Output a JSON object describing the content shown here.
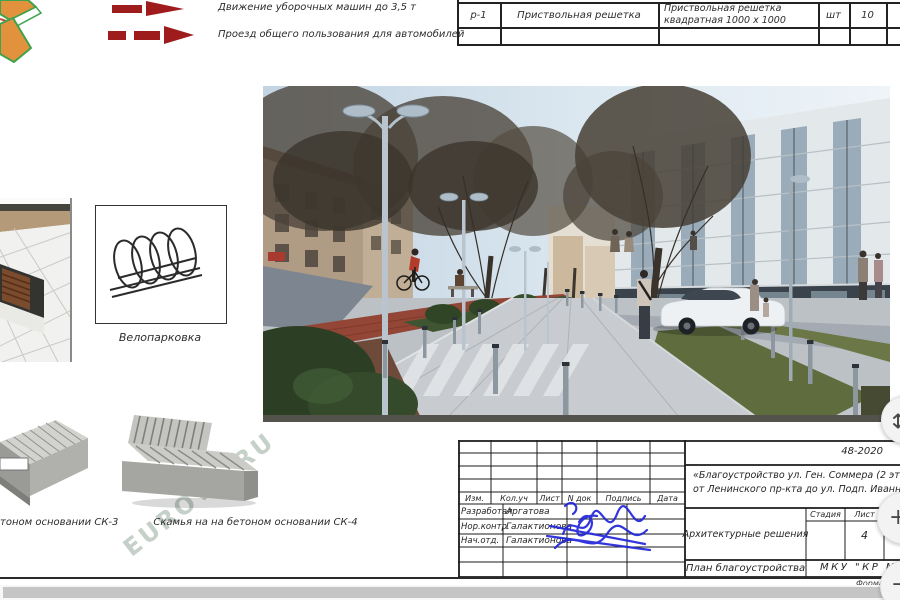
{
  "colors": {
    "legend_arrow_red": "#9e1c1c",
    "signature_blue": "#2126d8",
    "drawing_line": "#1f1f1f",
    "scrollbar_thumb": "#c5c5c5"
  },
  "legend": {
    "items": [
      {
        "label": "Движение уборочных машин до 3,5 т"
      },
      {
        "label": "Проезд общего пользования для автомобилей"
      }
    ]
  },
  "spec_table": {
    "rows": [
      {
        "mark": "р-1",
        "name": "Приствольная решетка",
        "desc_line1": "Приствольная решетка",
        "desc_line2": "квадратная 1000 х 1000",
        "unit": "шт",
        "qty": "10"
      }
    ]
  },
  "details": {
    "bike_parking_label": "Велопарковка",
    "bench_sk3_label": "тоном основании СК-3",
    "bench_sk4_label": "Скамья на на бетоном основании СК-4"
  },
  "watermark": {
    "text": "EUROVA.RU"
  },
  "title_block": {
    "doc_number": "48-2020",
    "project_line1": "«Благоустройство  ул. Ген. Соммера (2 этап",
    "project_line2": "от Ленинского пр-кта до ул. Подп. Иванникова)",
    "section_title": "Архитектурные решения",
    "sheet_title": "План благоустройства",
    "organization": "МКУ  \"КР М",
    "stage_header": "Стадия",
    "sheet_header": "Лист",
    "sheet_number": "4",
    "columns": [
      "Изм.",
      "Кол.уч",
      "Лист",
      "N док",
      "Подпись",
      "Дата"
    ],
    "signers": [
      {
        "role": "Разработал",
        "name": "Аргатова"
      },
      {
        "role": "Нор.контр.",
        "name": "Галактионова"
      },
      {
        "role": "Нач.отд.",
        "name": "Галактионова"
      }
    ],
    "format_note": "Формат"
  },
  "viewer": {
    "zoom_in_label": "+",
    "zoom_out_label": "−"
  }
}
